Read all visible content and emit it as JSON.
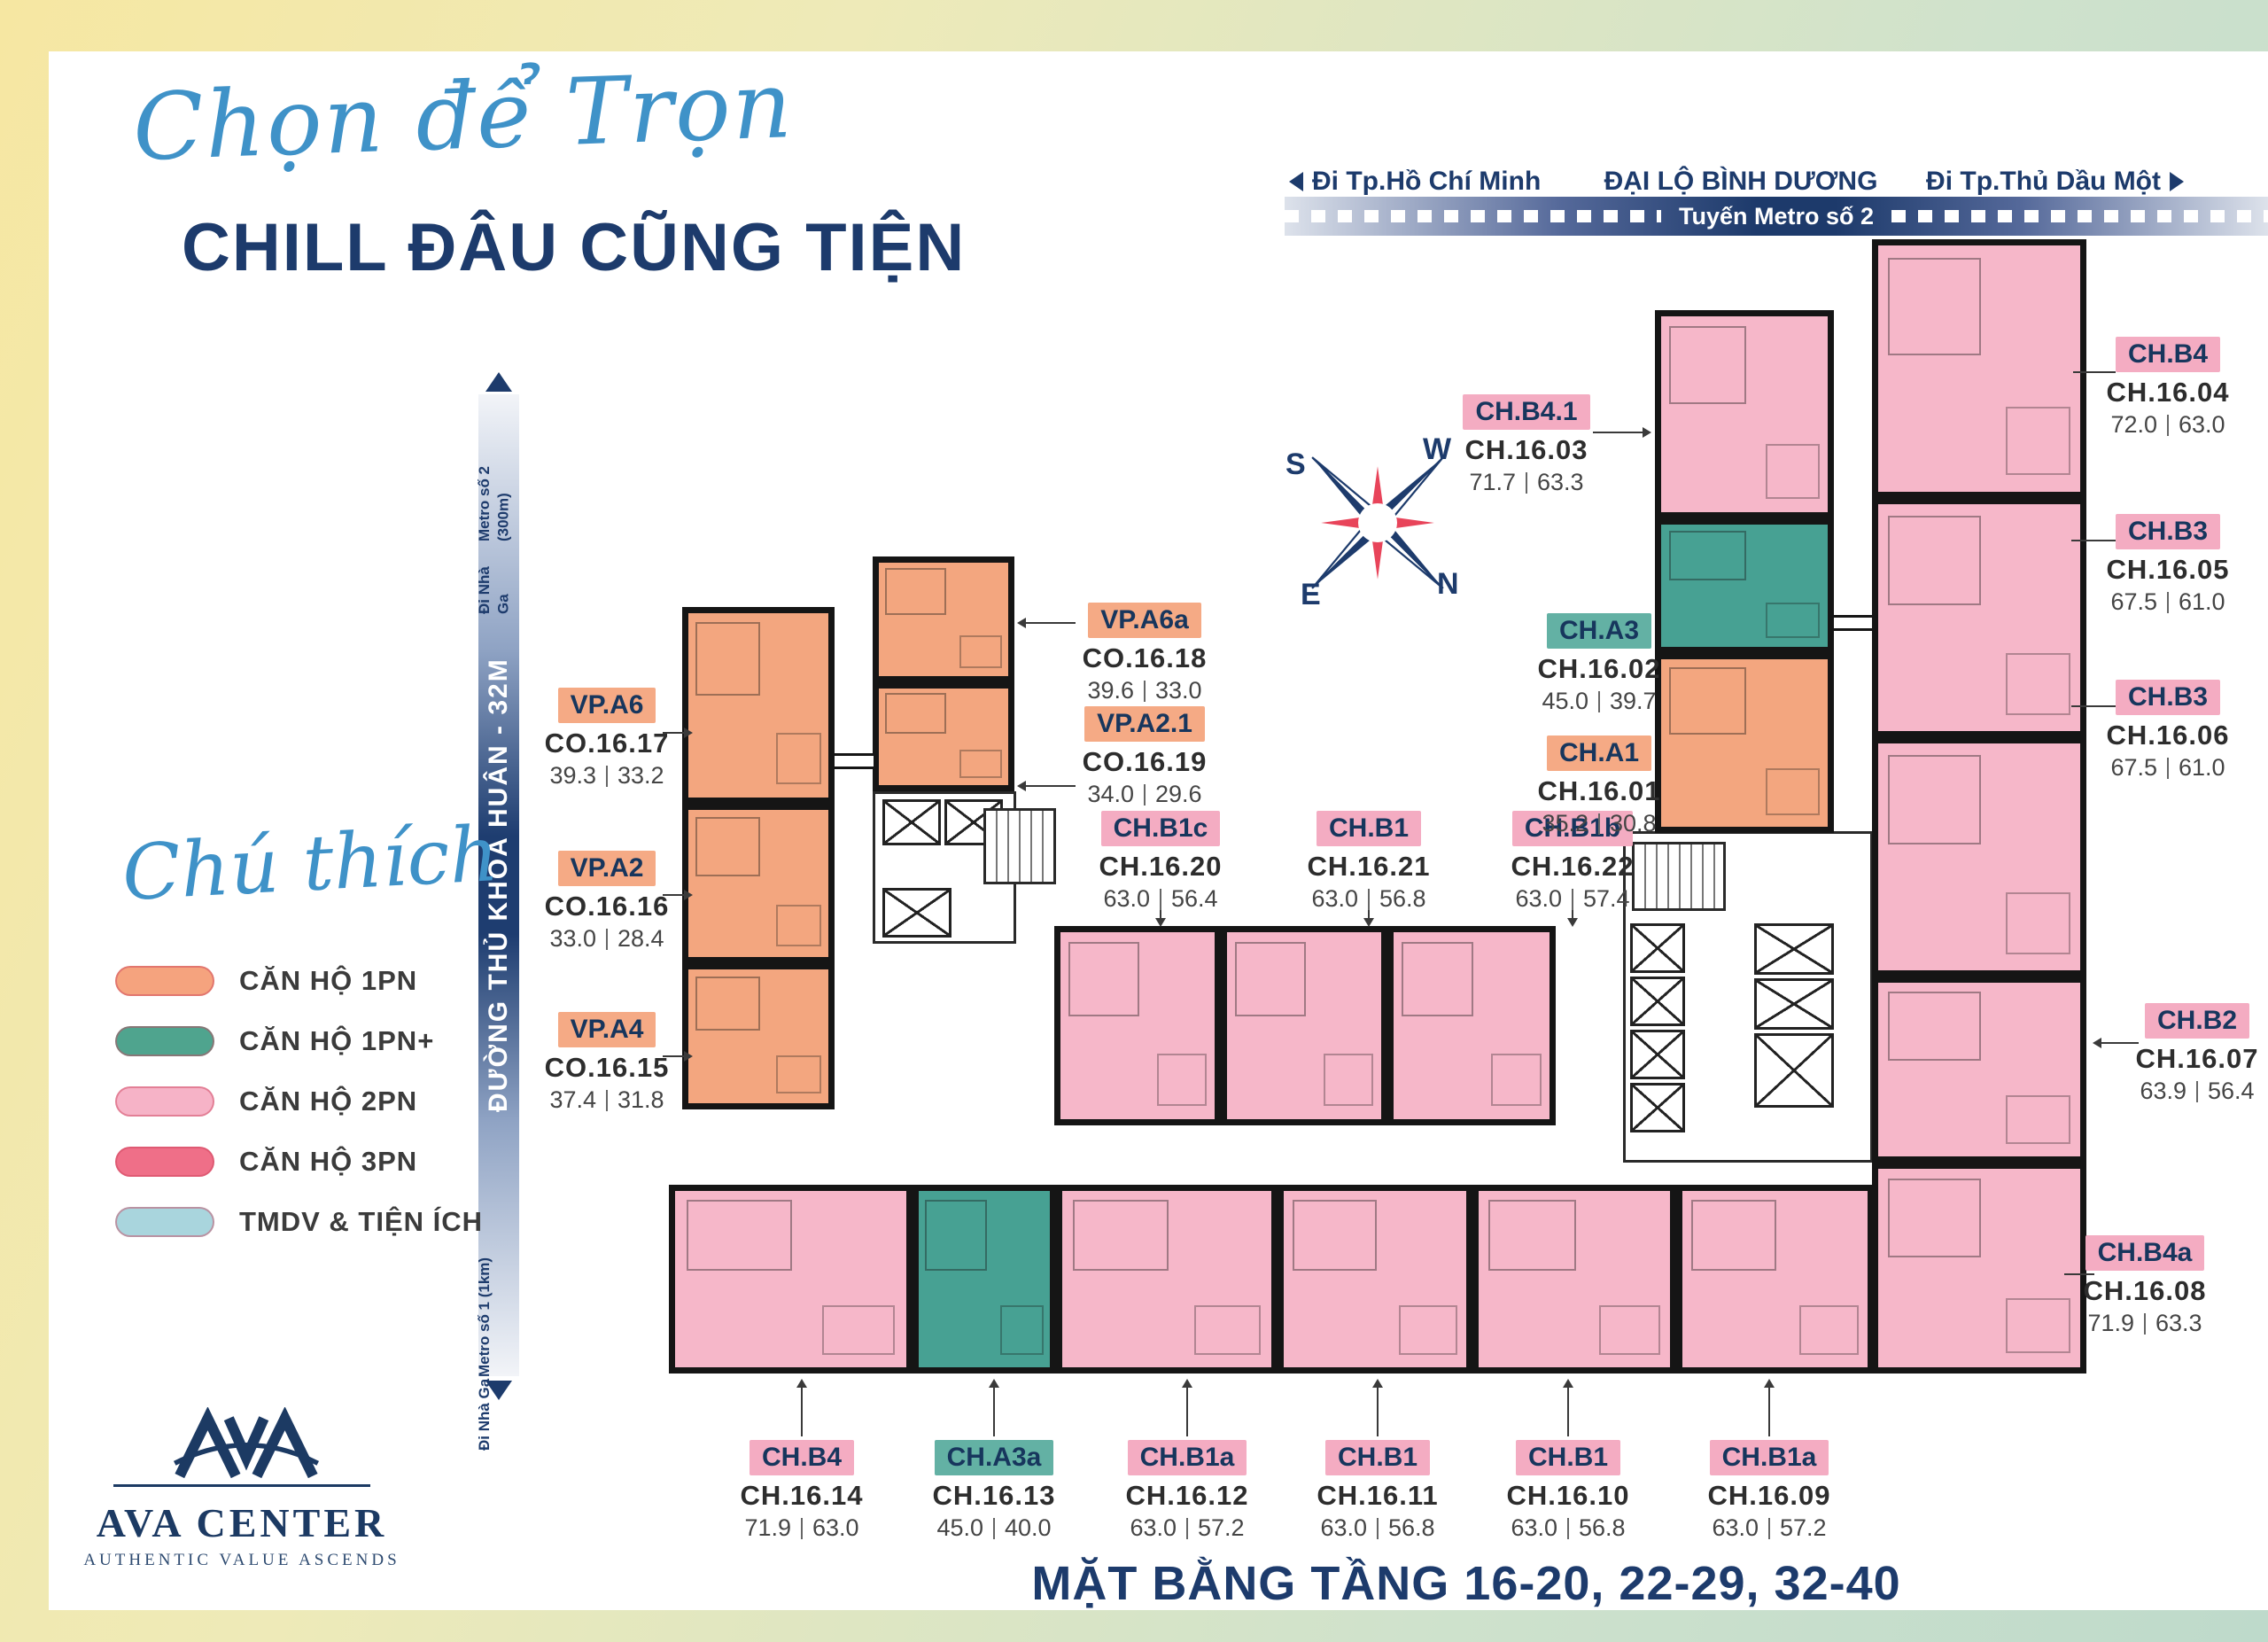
{
  "header": {
    "script_title": "Chọn để Trọn",
    "main_title": "CHILL ĐÂU CŨNG TIỆN"
  },
  "road_top": {
    "left_direction": "Đi Tp.Hồ Chí Minh",
    "road_name": "ĐẠI LỘ BÌNH DƯƠNG",
    "right_direction": "Đi Tp.Thủ Dầu Một",
    "metro_line": "Tuyến Metro số 2"
  },
  "road_left": {
    "road_name": "ĐƯỜNG THỦ KHOA HUÂN - 32M",
    "top_line1": "Đi Nhà Ga",
    "top_line2": "Metro số 2 (300m)",
    "bottom_line1": "Đi Nhà Ga",
    "bottom_line2": "Metro số 1 (1km)"
  },
  "legend": {
    "title": "Chú thích",
    "items": [
      {
        "label": "CĂN HỘ 1PN",
        "color": "#F5A37E",
        "type": "1pn"
      },
      {
        "label": "CĂN HỘ 1PN+",
        "color": "#4FA48E",
        "type": "1pn-plus"
      },
      {
        "label": "CĂN HỘ 2PN",
        "color": "#F6B3C7",
        "type": "2pn"
      },
      {
        "label": "CĂN HỘ 3PN",
        "color": "#EF6F88",
        "type": "3pn"
      },
      {
        "label": "TMDV & TIỆN ÍCH",
        "color": "#A9D5DD",
        "type": "tmdv"
      }
    ]
  },
  "compass": {
    "w": "W",
    "s": "S",
    "e": "E",
    "n": "N"
  },
  "logo": {
    "name": "AVA CENTER",
    "tagline": "AUTHENTIC VALUE ASCENDS"
  },
  "footer": {
    "title": "MẶT BẰNG TẦNG 16-20, 22-29, 32-40"
  },
  "colors": {
    "navy": "#1d3b6c",
    "script_blue": "#3f92c8",
    "unit_orange": "#F3A67F",
    "unit_pink": "#F6B7C9",
    "unit_teal": "#47A193",
    "legend_red": "#EF6F88",
    "legend_lightblue": "#A9D5DD"
  },
  "units": [
    {
      "tag": "VP.A6",
      "code": "CO.16.17",
      "gross": "39.3",
      "net": "33.2",
      "type": "1pn"
    },
    {
      "tag": "VP.A2",
      "code": "CO.16.16",
      "gross": "33.0",
      "net": "28.4",
      "type": "1pn"
    },
    {
      "tag": "VP.A4",
      "code": "CO.16.15",
      "gross": "37.4",
      "net": "31.8",
      "type": "1pn"
    },
    {
      "tag": "VP.A6a",
      "code": "CO.16.18",
      "gross": "39.6",
      "net": "33.0",
      "type": "1pn"
    },
    {
      "tag": "VP.A2.1",
      "code": "CO.16.19",
      "gross": "34.0",
      "net": "29.6",
      "type": "1pn"
    },
    {
      "tag": "CH.B1c",
      "code": "CH.16.20",
      "gross": "63.0",
      "net": "56.4",
      "type": "2pn"
    },
    {
      "tag": "CH.B1",
      "code": "CH.16.21",
      "gross": "63.0",
      "net": "56.8",
      "type": "2pn"
    },
    {
      "tag": "CH.B1b",
      "code": "CH.16.22",
      "gross": "63.0",
      "net": "57.4",
      "type": "2pn"
    },
    {
      "tag": "CH.B4.1",
      "code": "CH.16.03",
      "gross": "71.7",
      "net": "63.3",
      "type": "2pn"
    },
    {
      "tag": "CH.A3",
      "code": "CH.16.02",
      "gross": "45.0",
      "net": "39.7",
      "type": "1pn-plus"
    },
    {
      "tag": "CH.A1",
      "code": "CH.16.01",
      "gross": "35.2",
      "net": "30.8",
      "type": "1pn"
    },
    {
      "tag": "CH.B4",
      "code": "CH.16.04",
      "gross": "72.0",
      "net": "63.0",
      "type": "2pn"
    },
    {
      "tag": "CH.B3",
      "code": "CH.16.05",
      "gross": "67.5",
      "net": "61.0",
      "type": "2pn"
    },
    {
      "tag": "CH.B3",
      "code": "CH.16.06",
      "gross": "67.5",
      "net": "61.0",
      "type": "2pn"
    },
    {
      "tag": "CH.B2",
      "code": "CH.16.07",
      "gross": "63.9",
      "net": "56.4",
      "type": "2pn"
    },
    {
      "tag": "CH.B4a",
      "code": "CH.16.08",
      "gross": "71.9",
      "net": "63.3",
      "type": "2pn"
    },
    {
      "tag": "CH.B4",
      "code": "CH.16.14",
      "gross": "71.9",
      "net": "63.0",
      "type": "2pn"
    },
    {
      "tag": "CH.A3a",
      "code": "CH.16.13",
      "gross": "45.0",
      "net": "40.0",
      "type": "1pn-plus"
    },
    {
      "tag": "CH.B1a",
      "code": "CH.16.12",
      "gross": "63.0",
      "net": "57.2",
      "type": "2pn"
    },
    {
      "tag": "CH.B1",
      "code": "CH.16.11",
      "gross": "63.0",
      "net": "56.8",
      "type": "2pn"
    },
    {
      "tag": "CH.B1",
      "code": "CH.16.10",
      "gross": "63.0",
      "net": "56.8",
      "type": "2pn"
    },
    {
      "tag": "CH.B1a",
      "code": "CH.16.09",
      "gross": "63.0",
      "net": "57.2",
      "type": "2pn"
    }
  ]
}
